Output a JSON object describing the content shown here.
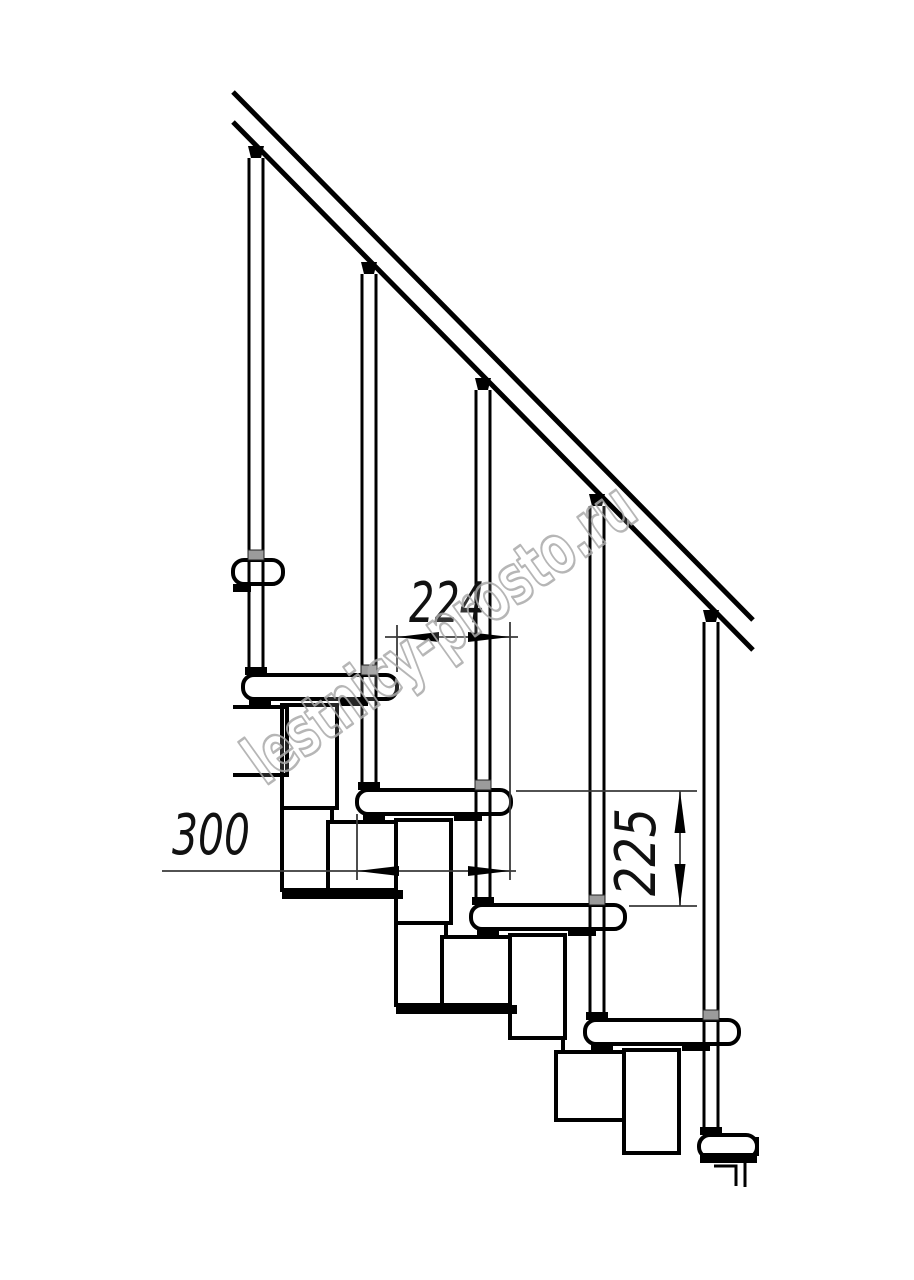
{
  "canvas": {
    "width": 914,
    "height": 1280,
    "background": "#ffffff",
    "ink": "#000000",
    "thin_line": "#3a3a3a",
    "connector_gray": "#9b9b9b",
    "watermark_gray": "#a9a9a9"
  },
  "watermark": {
    "text": "lestnicy-prosto.ru"
  },
  "annotations": {
    "dim_step_run": {
      "label": "224"
    },
    "dim_tread_depth": {
      "label": "300"
    },
    "dim_step_rise": {
      "label": "225"
    }
  },
  "drawing": {
    "description": "side-view technical drawing of modular staircase with handrail, balusters, treads, support modules, dimension lines",
    "primitives": [
      {
        "t": "rect",
        "n": "module-post-1-upper",
        "x": 282,
        "y": 705,
        "w": 55,
        "h": 103
      },
      {
        "t": "rect",
        "n": "module-post-1-lower",
        "x": 282,
        "y": 808,
        "w": 50,
        "h": 82
      },
      {
        "t": "rect",
        "n": "module-box-2",
        "x": 328,
        "y": 822,
        "w": 75,
        "h": 68
      },
      {
        "t": "rect",
        "n": "module-post-2-upper",
        "x": 396,
        "y": 820,
        "w": 55,
        "h": 103
      },
      {
        "t": "rect",
        "n": "module-post-2-lower",
        "x": 396,
        "y": 923,
        "w": 50,
        "h": 82
      },
      {
        "t": "rect",
        "n": "module-box-3",
        "x": 442,
        "y": 937,
        "w": 75,
        "h": 68
      },
      {
        "t": "rect",
        "n": "module-post-3-upper",
        "x": 510,
        "y": 935,
        "w": 55,
        "h": 103
      },
      {
        "t": "line",
        "n": "module-post-3-edge",
        "x1": 563,
        "y1": 1036,
        "x2": 563,
        "y2": 1054,
        "sw": 4
      },
      {
        "t": "rect",
        "n": "module-box-4",
        "x": 556,
        "y": 1052,
        "w": 75,
        "h": 68
      },
      {
        "t": "rect",
        "n": "module-post-4-upper",
        "x": 624,
        "y": 1050,
        "w": 55,
        "h": 103
      },
      {
        "t": "line",
        "n": "module-box-1-top",
        "x1": 233,
        "y1": 707,
        "x2": 287,
        "y2": 707,
        "sw": 4
      },
      {
        "t": "line",
        "n": "module-box-1-right",
        "x1": 287,
        "y1": 705,
        "x2": 287,
        "y2": 777,
        "sw": 4
      },
      {
        "t": "line",
        "n": "module-box-1-bottom",
        "x1": 233,
        "y1": 775,
        "x2": 289,
        "y2": 775,
        "sw": 4
      },
      {
        "t": "rect",
        "n": "module-band-1",
        "x": 282,
        "y": 890,
        "w": 121,
        "h": 9,
        "f": "#000000",
        "sw": 0
      },
      {
        "t": "rect",
        "n": "module-band-2",
        "x": 396,
        "y": 1005,
        "w": 121,
        "h": 9,
        "f": "#000000",
        "sw": 0
      },
      {
        "t": "rect",
        "n": "tread-0-partial",
        "x": 233,
        "y": 560,
        "w": 50,
        "h": 24,
        "rx": 11
      },
      {
        "t": "rect",
        "n": "tread-1",
        "x": 243,
        "y": 675,
        "w": 154,
        "h": 24,
        "rx": 11
      },
      {
        "t": "rect",
        "n": "tread-2",
        "x": 357,
        "y": 790,
        "w": 154,
        "h": 24,
        "rx": 11
      },
      {
        "t": "rect",
        "n": "tread-3",
        "x": 471,
        "y": 905,
        "w": 154,
        "h": 24,
        "rx": 11
      },
      {
        "t": "rect",
        "n": "tread-4",
        "x": 585,
        "y": 1020,
        "w": 154,
        "h": 24,
        "rx": 11
      },
      {
        "t": "rect",
        "n": "tread-5-partial",
        "x": 699,
        "y": 1135,
        "w": 58,
        "h": 23,
        "rx": 11
      },
      {
        "t": "rect",
        "n": "tread-0-mount",
        "x": 233,
        "y": 584,
        "w": 18,
        "h": 8,
        "f": "#000000",
        "sw": 0
      },
      {
        "t": "rect",
        "n": "tread-1-mount-left",
        "x": 249,
        "y": 699,
        "w": 22,
        "h": 7,
        "f": "#000000",
        "sw": 0
      },
      {
        "t": "rect",
        "n": "tread-1-mount-right",
        "x": 340,
        "y": 699,
        "w": 28,
        "h": 7,
        "f": "#000000",
        "sw": 0
      },
      {
        "t": "rect",
        "n": "tread-2-mount-left",
        "x": 363,
        "y": 814,
        "w": 22,
        "h": 7,
        "f": "#000000",
        "sw": 0
      },
      {
        "t": "rect",
        "n": "tread-2-mount-right",
        "x": 454,
        "y": 814,
        "w": 28,
        "h": 7,
        "f": "#000000",
        "sw": 0
      },
      {
        "t": "rect",
        "n": "tread-3-mount-left",
        "x": 477,
        "y": 929,
        "w": 22,
        "h": 7,
        "f": "#000000",
        "sw": 0
      },
      {
        "t": "rect",
        "n": "tread-3-mount-right",
        "x": 568,
        "y": 929,
        "w": 28,
        "h": 7,
        "f": "#000000",
        "sw": 0
      },
      {
        "t": "rect",
        "n": "tread-4-mount-left",
        "x": 591,
        "y": 1044,
        "w": 22,
        "h": 7,
        "f": "#000000",
        "sw": 0
      },
      {
        "t": "rect",
        "n": "tread-4-mount-right",
        "x": 682,
        "y": 1044,
        "w": 28,
        "h": 7,
        "f": "#000000",
        "sw": 0
      },
      {
        "t": "rect",
        "n": "tread-5-mount-band",
        "x": 700,
        "y": 1153,
        "w": 57,
        "h": 10,
        "f": "#000000",
        "sw": 0
      },
      {
        "t": "line",
        "n": "tread-5-cut-edge",
        "x1": 757,
        "y1": 1137,
        "x2": 757,
        "y2": 1156,
        "sw": 4
      },
      {
        "t": "pline",
        "n": "drawing-break-step",
        "pts": "714,1166 736,1166 736,1186",
        "sw": 3
      },
      {
        "t": "line",
        "n": "drawing-break-line",
        "x1": 745,
        "y1": 1163,
        "x2": 745,
        "y2": 1187,
        "sw": 3
      },
      {
        "t": "line",
        "n": "handrail-upper-line",
        "x1": 233,
        "y1": 92,
        "x2": 753,
        "y2": 620,
        "sw": 5
      },
      {
        "t": "line",
        "n": "handrail-lower-line",
        "x1": 233,
        "y1": 122,
        "x2": 753,
        "y2": 650,
        "sw": 5
      },
      {
        "t": "line",
        "n": "baluster-1-line-left",
        "x1": 249,
        "y1": 158,
        "x2": 249,
        "y2": 667,
        "sw": 3
      },
      {
        "t": "line",
        "n": "baluster-1-line-right",
        "x1": 263,
        "y1": 158,
        "x2": 263,
        "y2": 667,
        "sw": 3
      },
      {
        "t": "poly",
        "n": "baluster-1-rail-wedge",
        "pts": "248,146 264,146 261,158 251,158",
        "f": "#000000"
      },
      {
        "t": "rect",
        "n": "baluster-1-foot",
        "x": 245,
        "y": 667,
        "w": 22,
        "h": 8,
        "f": "#000000",
        "sw": 0
      },
      {
        "t": "rect",
        "n": "baluster-1-tread-collar",
        "x": 248,
        "y": 550,
        "w": 16,
        "h": 10,
        "f": "#9b9b9b",
        "s": "#222222",
        "sw": 1
      },
      {
        "t": "line",
        "n": "baluster-2-line-left",
        "x1": 362,
        "y1": 274,
        "x2": 362,
        "y2": 782,
        "sw": 3
      },
      {
        "t": "line",
        "n": "baluster-2-line-right",
        "x1": 376,
        "y1": 274,
        "x2": 376,
        "y2": 782,
        "sw": 3
      },
      {
        "t": "poly",
        "n": "baluster-2-rail-wedge",
        "pts": "361,262 377,262 374,274 364,274",
        "f": "#000000"
      },
      {
        "t": "rect",
        "n": "baluster-2-foot",
        "x": 358,
        "y": 782,
        "w": 22,
        "h": 8,
        "f": "#000000",
        "sw": 0
      },
      {
        "t": "rect",
        "n": "baluster-2-tread-collar",
        "x": 361,
        "y": 665,
        "w": 16,
        "h": 10,
        "f": "#9b9b9b",
        "s": "#222222",
        "sw": 1
      },
      {
        "t": "line",
        "n": "baluster-3-line-left",
        "x1": 476,
        "y1": 390,
        "x2": 476,
        "y2": 897,
        "sw": 3
      },
      {
        "t": "line",
        "n": "baluster-3-line-right",
        "x1": 490,
        "y1": 390,
        "x2": 490,
        "y2": 897,
        "sw": 3
      },
      {
        "t": "poly",
        "n": "baluster-3-rail-wedge",
        "pts": "475,378 491,378 488,390 478,390",
        "f": "#000000"
      },
      {
        "t": "rect",
        "n": "baluster-3-foot",
        "x": 472,
        "y": 897,
        "w": 22,
        "h": 8,
        "f": "#000000",
        "sw": 0
      },
      {
        "t": "rect",
        "n": "baluster-3-tread-collar",
        "x": 475,
        "y": 780,
        "w": 16,
        "h": 10,
        "f": "#9b9b9b",
        "s": "#222222",
        "sw": 1
      },
      {
        "t": "line",
        "n": "baluster-4-line-left",
        "x1": 590,
        "y1": 506,
        "x2": 590,
        "y2": 1012,
        "sw": 3
      },
      {
        "t": "line",
        "n": "baluster-4-line-right",
        "x1": 604,
        "y1": 506,
        "x2": 604,
        "y2": 1012,
        "sw": 3
      },
      {
        "t": "poly",
        "n": "baluster-4-rail-wedge",
        "pts": "589,494 605,494 602,506 592,506",
        "f": "#000000"
      },
      {
        "t": "rect",
        "n": "baluster-4-foot",
        "x": 586,
        "y": 1012,
        "w": 22,
        "h": 8,
        "f": "#000000",
        "sw": 0
      },
      {
        "t": "rect",
        "n": "baluster-4-tread-collar",
        "x": 589,
        "y": 895,
        "w": 16,
        "h": 10,
        "f": "#9b9b9b",
        "s": "#222222",
        "sw": 1
      },
      {
        "t": "line",
        "n": "baluster-5-line-left",
        "x1": 704,
        "y1": 622,
        "x2": 704,
        "y2": 1127,
        "sw": 3
      },
      {
        "t": "line",
        "n": "baluster-5-line-right",
        "x1": 718,
        "y1": 622,
        "x2": 718,
        "y2": 1127,
        "sw": 3
      },
      {
        "t": "poly",
        "n": "baluster-5-rail-wedge",
        "pts": "703,610 719,610 716,622 706,622",
        "f": "#000000"
      },
      {
        "t": "rect",
        "n": "baluster-5-foot",
        "x": 700,
        "y": 1127,
        "w": 22,
        "h": 8,
        "f": "#000000",
        "sw": 0
      },
      {
        "t": "rect",
        "n": "baluster-5-tread-collar",
        "x": 703,
        "y": 1010,
        "w": 16,
        "h": 10,
        "f": "#9b9b9b",
        "s": "#222222",
        "sw": 1
      },
      {
        "t": "line",
        "n": "dim-224-line",
        "x1": 385,
        "y1": 637,
        "x2": 518,
        "y2": 637,
        "sw": 1.8,
        "s": "#3a3a3a"
      },
      {
        "t": "line",
        "n": "dim-224-ext-left",
        "x1": 397,
        "y1": 625,
        "x2": 397,
        "y2": 672,
        "sw": 1.8,
        "s": "#3a3a3a"
      },
      {
        "t": "line",
        "n": "dim-224-ext-right",
        "x1": 510,
        "y1": 622,
        "x2": 510,
        "y2": 880,
        "sw": 1.8,
        "s": "#3a3a3a"
      },
      {
        "t": "poly",
        "n": "dim-224-arrow-left",
        "pts": "397,637 439,632 439,642",
        "f": "#000000"
      },
      {
        "t": "poly",
        "n": "dim-224-arrow-right",
        "pts": "510,637 468,632 468,642",
        "f": "#000000"
      },
      {
        "t": "line",
        "n": "dim-300-line",
        "x1": 162,
        "y1": 871,
        "x2": 516,
        "y2": 871,
        "sw": 1.8,
        "s": "#3a3a3a"
      },
      {
        "t": "line",
        "n": "dim-300-ext-left",
        "x1": 357,
        "y1": 814,
        "x2": 357,
        "y2": 880,
        "sw": 1.8,
        "s": "#3a3a3a"
      },
      {
        "t": "poly",
        "n": "dim-300-arrow-left",
        "pts": "357,871 399,866 399,876",
        "f": "#000000"
      },
      {
        "t": "poly",
        "n": "dim-300-arrow-right",
        "pts": "510,871 468,866 468,876",
        "f": "#000000"
      },
      {
        "t": "line",
        "n": "dim-225-line",
        "x1": 680,
        "y1": 791,
        "x2": 680,
        "y2": 906,
        "sw": 1.8,
        "s": "#3a3a3a"
      },
      {
        "t": "line",
        "n": "dim-225-ext-top",
        "x1": 516,
        "y1": 791,
        "x2": 697,
        "y2": 791,
        "sw": 1.8,
        "s": "#3a3a3a"
      },
      {
        "t": "line",
        "n": "dim-225-ext-bottom",
        "x1": 629,
        "y1": 906,
        "x2": 697,
        "y2": 906,
        "sw": 1.8,
        "s": "#3a3a3a"
      },
      {
        "t": "poly",
        "n": "dim-225-arrow-up",
        "pts": "680,791 674.5,833 685.5,833",
        "f": "#000000"
      },
      {
        "t": "poly",
        "n": "dim-225-arrow-down",
        "pts": "680,906 674.5,864 685.5,864",
        "f": "#000000"
      },
      {
        "t": "text",
        "n": "dim-224-label",
        "bind": "annotations.dim_step_run.label",
        "x": 447,
        "y": 622,
        "fs": 56,
        "tl": 76,
        "cls": "dim"
      },
      {
        "t": "text",
        "n": "dim-300-label",
        "bind": "annotations.dim_tread_depth.label",
        "x": 211,
        "y": 854,
        "fs": 56,
        "tl": 78,
        "cls": "dim"
      },
      {
        "t": "text",
        "n": "dim-225-label",
        "bind": "annotations.dim_step_rise.label",
        "transform": "translate(655,852) rotate(-90)",
        "x": 0,
        "y": 0,
        "fs": 56,
        "tl": 88,
        "cls": "dim"
      },
      {
        "t": "text",
        "n": "watermark-text",
        "bind": "watermark.text",
        "transform": "translate(453,652) rotate(-35.6)",
        "x": 0,
        "y": 0,
        "fs": 68,
        "tl": 462,
        "cls": "wm"
      }
    ]
  }
}
